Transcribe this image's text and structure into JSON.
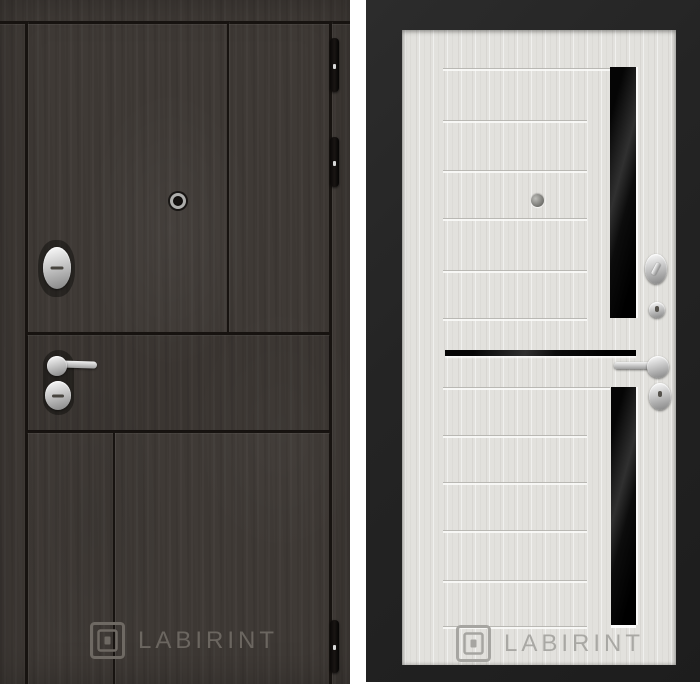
{
  "brand": {
    "wordmark": "LABIRINT"
  },
  "colors": {
    "gap-white": "#ffffff",
    "wood": "#3f3a36",
    "wood-groove": "#171310",
    "frame-dark": "#242424",
    "door-white": "#e2e1dd",
    "glass-black": "#0a0a0a",
    "metal-light": "#f0f0f0",
    "metal-dark": "#8d8d8d",
    "wm-left": "#6e6963",
    "wm-right": "#a6a5a1"
  },
  "left_door": {
    "side": "exterior dark wood panel",
    "watermark": "LABIRINT",
    "hardware": [
      "hinge",
      "hinge",
      "hinge",
      "peephole",
      "cylinder-lock",
      "lever-handle",
      "cylinder-escutcheon"
    ]
  },
  "right_door": {
    "side": "interior light wood panel with black glass inserts",
    "watermark": "LABIRINT",
    "hardware": [
      "peephole",
      "thumb-turn",
      "cylinder",
      "lever-handle",
      "cylinder-escutcheon"
    ]
  }
}
